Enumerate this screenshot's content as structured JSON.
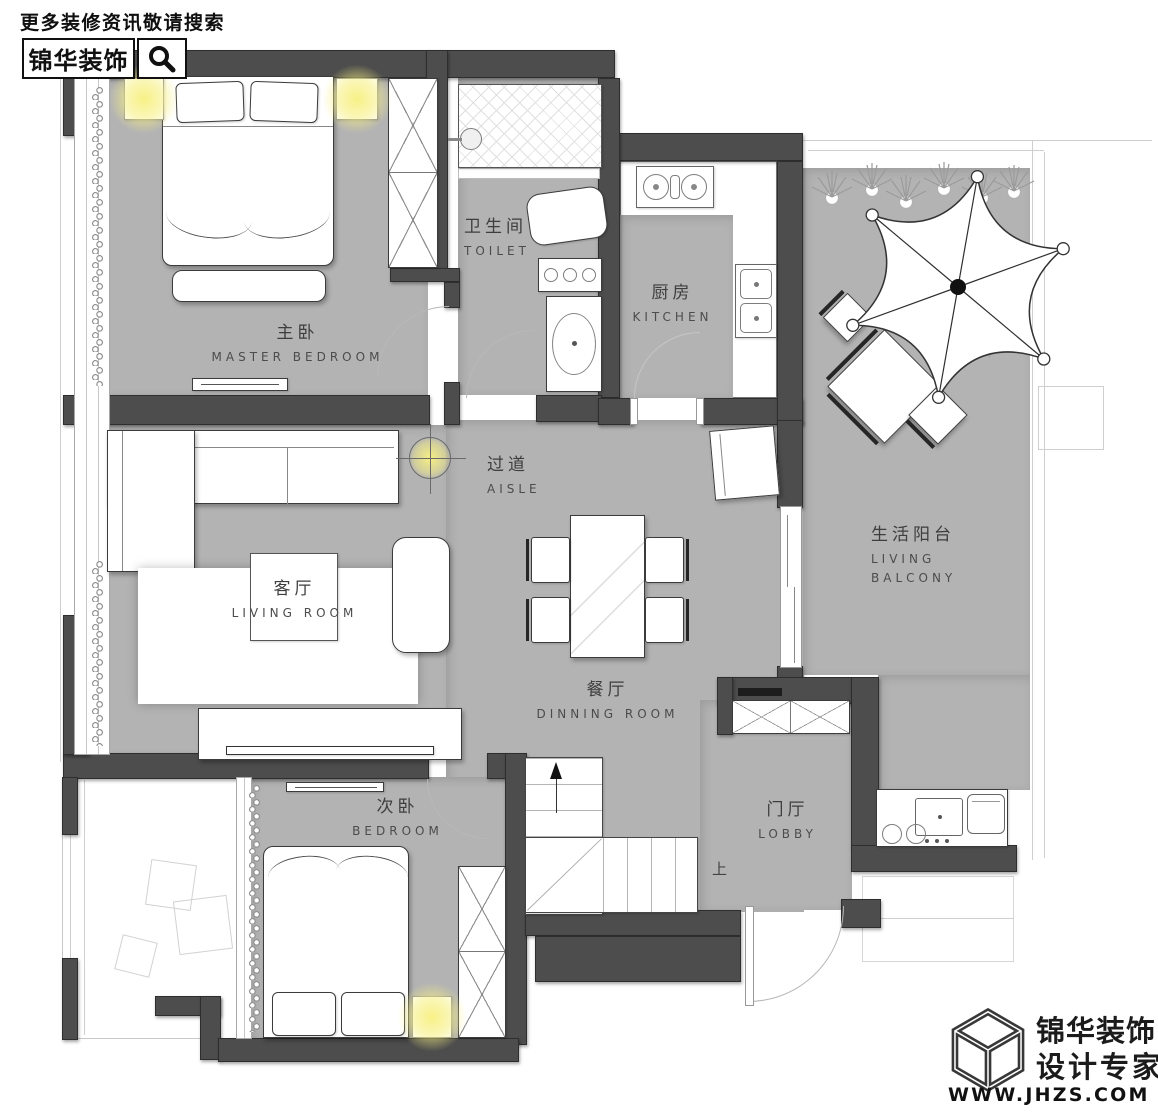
{
  "header": {
    "tagline": "更多装修资讯敬请搜索",
    "brand": "锦华装饰",
    "search_icon": "magnifier-icon"
  },
  "rooms": {
    "master_bedroom": {
      "cn": "主卧",
      "en": "MASTER BEDROOM"
    },
    "toilet": {
      "cn": "卫生间",
      "en": "TOILET"
    },
    "kitchen": {
      "cn": "厨房",
      "en": "KITCHEN"
    },
    "living_balcony": {
      "cn": "生活阳台",
      "en1": "LIVING",
      "en2": "BALCONY"
    },
    "aisle": {
      "cn": "过道",
      "en": "AISLE"
    },
    "living_room": {
      "cn": "客厅",
      "en": "LIVING ROOM"
    },
    "dining_room": {
      "cn": "餐厅",
      "en": "DINNING ROOM"
    },
    "bedroom": {
      "cn": "次卧",
      "en": "BEDROOM"
    },
    "lobby": {
      "cn": "门厅",
      "en": "LOBBY"
    }
  },
  "annotations": {
    "stairs_up": "上"
  },
  "footer": {
    "brand": "锦华装饰",
    "tagline": "设计专家",
    "website": "WWW.JHZS.COM",
    "logo_icon": "cube-logo-icon"
  },
  "colors": {
    "wall": "#4d4d4d",
    "floor": "#b3b3b3",
    "lamp_glow": "#f7f095"
  }
}
